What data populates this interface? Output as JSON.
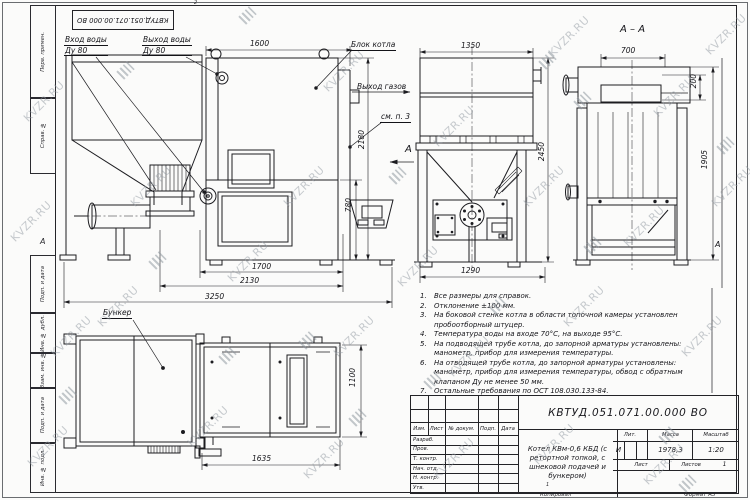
{
  "watermark": {
    "text": "KVZR.RU"
  },
  "top_stamp": {
    "designation": "КВТУД.051.071.00.000 ВО"
  },
  "margins": {
    "col_labels": [
      "Перв. примен.",
      "Справ. №",
      "Подп. и дата",
      "Инв. № дубл.",
      "Взам. инв. №",
      "Подп. и дата",
      "Инв. № подл."
    ],
    "zone_left": "А",
    "zone_right": "А",
    "fold_top": "2",
    "fold_bottom": "1"
  },
  "labels": {
    "water_in_1": "Вход воды",
    "water_in_2": "Ду 80",
    "water_out_1": "Выход воды",
    "water_out_2": "Ду 80",
    "boiler_block": "Блок котла",
    "gas_out": "Выход газов",
    "see_note": "см. п. 3",
    "section_title": "А – А",
    "view_arrow": "А",
    "bunker": "Бункер"
  },
  "dims": {
    "d1600": "1600",
    "d2180": "2180",
    "d780": "780",
    "d1700": "1700",
    "d2130": "2130",
    "d3250": "3250",
    "d1350": "1350",
    "d2450": "2450",
    "d1290": "1290",
    "d700": "700",
    "d200": "200",
    "d1905": "1905",
    "d1635": "1635",
    "d1100": "1100"
  },
  "notes": {
    "items": [
      {
        "num": "1.",
        "text": "Все размеры для справок."
      },
      {
        "num": "2.",
        "text": "Отклонение ±100 мм."
      },
      {
        "num": "3.",
        "text": "На боковой стенке котла в области топочной камеры установлен пробоотборный штуцер."
      },
      {
        "num": "4.",
        "text": "Температура воды на входе 70°С, на выходе 95°С."
      },
      {
        "num": "5.",
        "text": "На подводящей трубе котла, до запорной арматуры установлены: манометр, прибор для измерения температуры."
      },
      {
        "num": "6.",
        "text": "На отводящей трубе котла, до запорной арматуры установлены: манометр, прибор для измерения температуры, обвод с обратным клапаном Ду не менее 50 мм."
      },
      {
        "num": "7.",
        "text": "Остальные требования по ОСТ 108.030.133-84."
      }
    ]
  },
  "title_block": {
    "designation": "КВТУД.051.071.00.000 ВО",
    "name": "Котел КВм-0,6 КБД (с ретортной топкой, с шнековой подачей и бункером)",
    "change_cols": [
      "Изм.",
      "Лист",
      "№ докум.",
      "Подп.",
      "Дата"
    ],
    "sig_rows": [
      "Разраб.",
      "Пров.",
      "Т. контр.",
      "Нач. отд.",
      "Н. контр.",
      "Утв."
    ],
    "lit_header": "Лит.",
    "mass_header": "Масса",
    "scale_header": "Масштаб",
    "lit_value": "И",
    "mass_value": "1978,3",
    "scale_value": "1:20",
    "sheet_label": "Лист",
    "sheets_label": "Листов",
    "sheets_value": "1",
    "copied": "Копировал",
    "format": "Формат А3"
  }
}
